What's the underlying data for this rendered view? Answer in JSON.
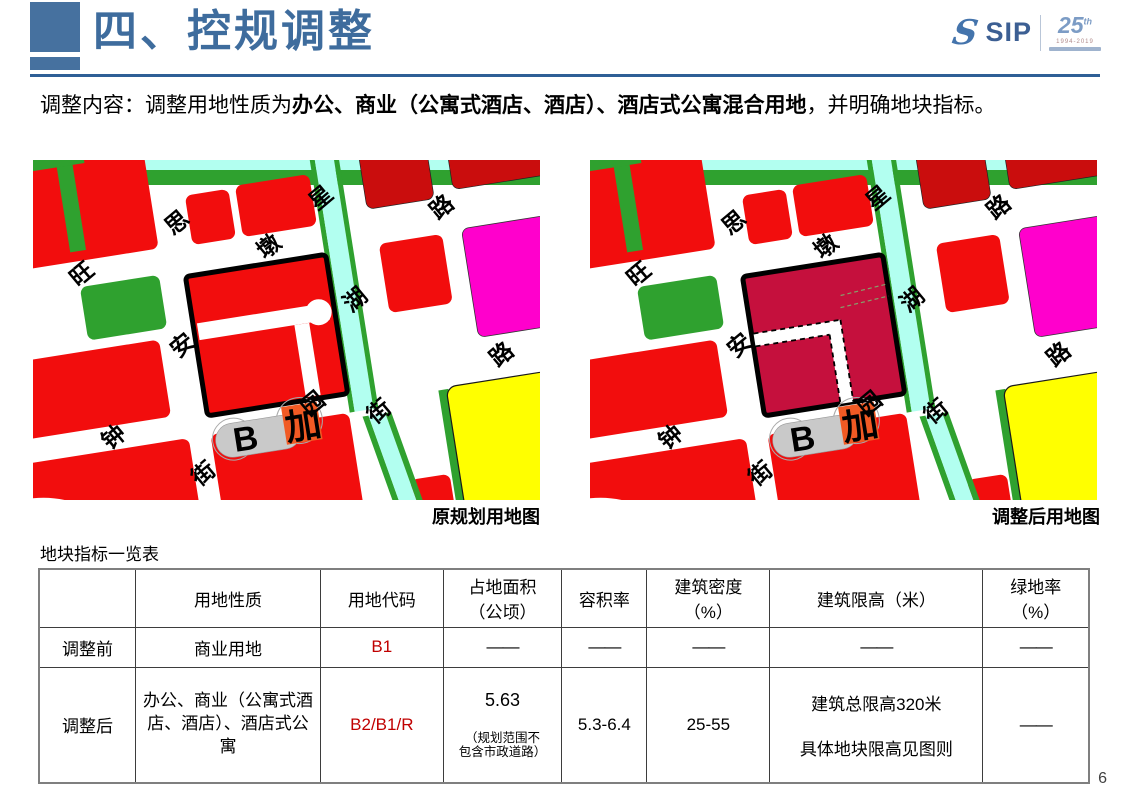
{
  "header": {
    "title": "四、控规调整",
    "logo": {
      "sip": "SIP",
      "swirl": "S",
      "anniversary": "25",
      "anniversary_sup": "th",
      "years": "1994-2019"
    }
  },
  "intro": {
    "prefix": "调整内容：调整用地性质为",
    "bold": "办公、商业（公寓式酒店、酒店）、酒店式公寓混合用地",
    "suffix": "，并明确地块指标。"
  },
  "maps": {
    "original_caption": "原规划用地图",
    "adjusted_caption": "调整后用地图",
    "marker_b": "B",
    "marker_jia": "加",
    "street_labels": [
      {
        "text": "星",
        "x": 312,
        "y": 52
      },
      {
        "text": "思",
        "x": 166,
        "y": 54
      },
      {
        "text": "路",
        "x": 430,
        "y": 80
      },
      {
        "text": "墩",
        "x": 253,
        "y": 92
      },
      {
        "text": "旺",
        "x": 64,
        "y": 90
      },
      {
        "text": "湖",
        "x": 330,
        "y": 158
      },
      {
        "text": "安",
        "x": 152,
        "y": 176
      },
      {
        "text": "路",
        "x": 466,
        "y": 235
      },
      {
        "text": "园",
        "x": 272,
        "y": 254
      },
      {
        "text": "街",
        "x": 336,
        "y": 272
      },
      {
        "text": "钟",
        "x": 70,
        "y": 256
      },
      {
        "text": "街",
        "x": 153,
        "y": 306
      }
    ]
  },
  "colors": {
    "accent": "#46719F",
    "title": "#3E6C9D",
    "rule": "#2E5F96",
    "code_red": "#C00000",
    "map_red": "#F20D0D",
    "map_dark_red": "#CA0D0D",
    "map_green": "#2FA12F",
    "map_cyan": "#B2FFF0",
    "map_magenta": "#FF00CC",
    "map_yellow": "#FFFF00",
    "map_orange": "#F15A24",
    "map_gray": "#C9C9C9",
    "parcel_before": "#F20D0D",
    "parcel_after": "#C5103D"
  },
  "table": {
    "title": "地块指标一览表",
    "headers": [
      "用地性质",
      "用地代码",
      "占地面积\n（公顷）",
      "容积率",
      "建筑密度\n（%）",
      "建筑限高（米）",
      "绿地率\n（%）"
    ],
    "rows": [
      {
        "label": "调整前",
        "land_use": "商业用地",
        "code": "B1",
        "area": "——",
        "far": "——",
        "density": "——",
        "height": "——",
        "green": "——"
      },
      {
        "label": "调整后",
        "land_use": "办公、商业（公寓式酒店、酒店）、酒店式公寓",
        "code": "B2/B1/R",
        "area_main": "5.63",
        "area_note": "（规划范围不\n包含市政道路）",
        "far": "5.3-6.4",
        "density": "25-55",
        "height": "建筑总限高320米\n\n具体地块限高见图则",
        "green": "——"
      }
    ]
  },
  "page_number": "6"
}
